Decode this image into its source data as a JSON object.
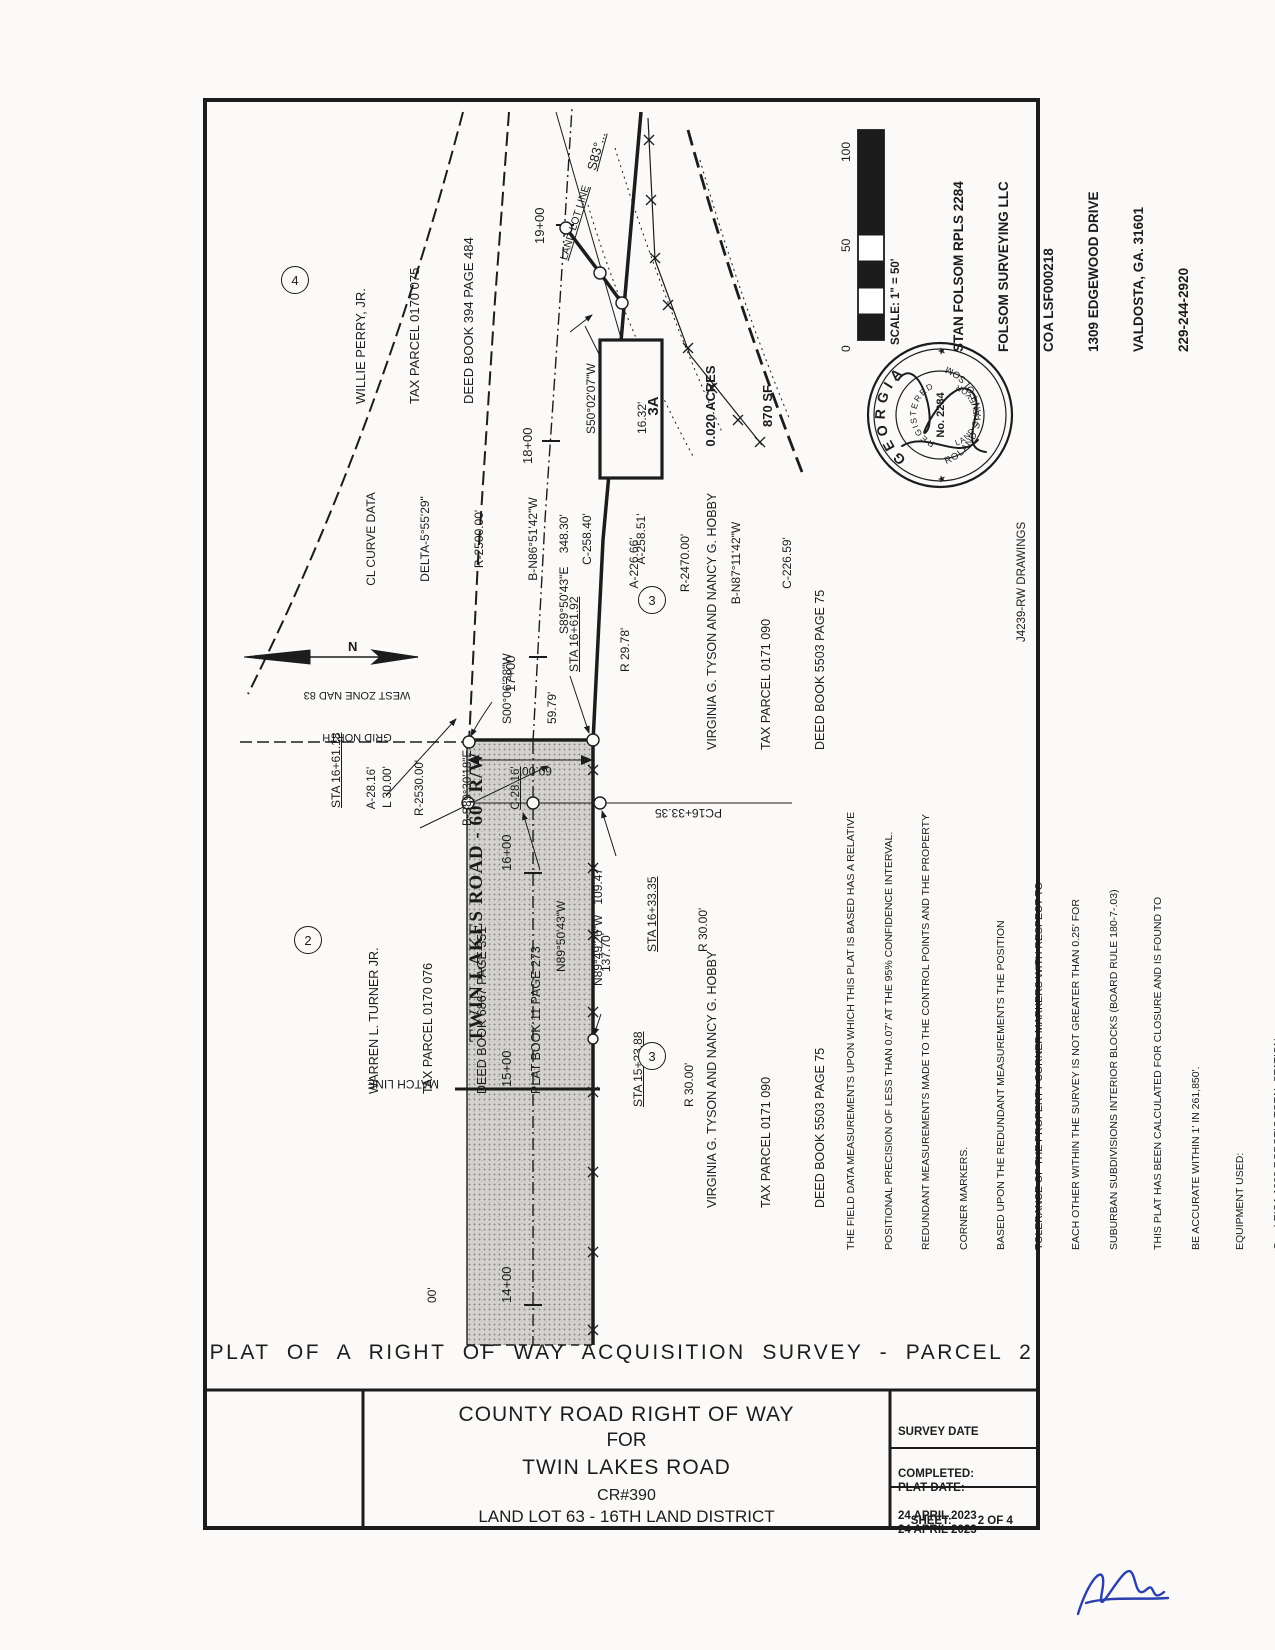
{
  "colors": {
    "ink": "#1c1c1c",
    "paper": "#fbfaf8",
    "road_fill": "#d3d2cf",
    "signature_blue": "#2b3fae"
  },
  "sheet": {
    "plat_title": "PLAT  OF  A  RIGHT  OF  WAY  ACQUISITION  SURVEY  -  PARCEL  2",
    "drawing_ref": "J4239-RW DRAWINGS"
  },
  "title_block": {
    "line1": "COUNTY ROAD RIGHT OF WAY",
    "line2": "FOR",
    "line3": "TWIN LAKES ROAD",
    "line4": "CR#390",
    "line5": "LAND LOT 63 - 16TH LAND DISTRICT",
    "survey_date_label": "SURVEY DATE",
    "survey_completed_label": "COMPLETED:",
    "survey_date": "24 APRIL 2023",
    "plat_date_label": "PLAT DATE:",
    "plat_date": "24 APRIL 2023",
    "sheet_label": "SHEET:",
    "sheet_value": "2 OF 4"
  },
  "surveyor": {
    "line1": "STAN FOLSOM RPLS 2284",
    "line2": "FOLSOM SURVEYING LLC",
    "line3": "COA LSF000218",
    "line4": "1309 EDGEWOOD DRIVE",
    "line5": "VALDOSTA, GA. 31601",
    "line6": "229-244-2920"
  },
  "scale_bar": {
    "label": "SCALE: 1\" = 50'",
    "tick0": "0",
    "tick50": "50",
    "tick100": "100"
  },
  "north_arrow": {
    "n": "N",
    "line1": "GRID NORTH",
    "line2": "WEST ZONE NAD 83"
  },
  "seal": {
    "state": "GEORGIA",
    "registered": "REGISTERED",
    "number": "No. 2284",
    "title": "LAND SURVEYOR",
    "name": "ROLAND STAN FOLSOM",
    "star": "★"
  },
  "parcels": {
    "perry": {
      "num": "4",
      "line1": "WILLIE PERRY, JR.",
      "line2": "TAX PARCEL 0170 075",
      "line3": "DEED BOOK 394 PAGE 484"
    },
    "turner": {
      "num": "2",
      "line1": "WARREN L. TURNER JR.",
      "line2": "TAX PARCEL 0170 076",
      "line3": "DEED BOOK 6867 PAGE 351",
      "line4": "PLAT BOOK 11 PAGE 273"
    },
    "tyson": {
      "num": "3",
      "line1": "VIRGINIA G. TYSON AND NANCY G. HOBBY",
      "line2": "TAX PARCEL 0171 090",
      "line3": "DEED BOOK 5503 PAGE 75"
    }
  },
  "area_box": {
    "id": "3A",
    "acres": "0.020 ACRES",
    "sf": "870 SF"
  },
  "cl_curve": {
    "title": "CL CURVE DATA",
    "delta": "DELTA-5°55'29\"",
    "r": "R-2500.00'",
    "b": "B-N86°51'42\"W",
    "c": "C-258.40'",
    "a": "A-258.51'"
  },
  "curve2": {
    "a": "A-226.66'",
    "r": "R-2470.00'",
    "b": "B-N87°11'42\"W",
    "c": "C-226.59'"
  },
  "curve3": {
    "a": "A-28.16'",
    "r": "R-2530.00'",
    "b": "B-S89°30'18\"E",
    "c": "C-28.16'"
  },
  "road": {
    "name": "TWIN LAKES ROAD - 60' R/W",
    "width_dim": "60.00'",
    "partial_dim": "00'"
  },
  "stations": {
    "s14": "14+00",
    "s15": "15+00",
    "s16": "16+00",
    "s17": "17+00",
    "s18": "18+00",
    "s19": "19+00"
  },
  "bearings": {
    "s50": "S50°02'07\"W",
    "s50_d": "16.32'",
    "s89": "S89°50'43\"E    348.30'",
    "s00": "S00°06'38\"W",
    "s00_d": "59.79'",
    "n89a": "N89°50'43\"W",
    "n89a_d": "137.70'",
    "n89b": "N89°49'26\"W   109.47'",
    "s83": "S83°..."
  },
  "sta_labels": {
    "sta16_61_92": "STA 16+61.92",
    "sta16_61_92_r": "R 29.78'",
    "sta16_61_18": "STA 16+61.18",
    "sta16_61_18_l": "L 30.00'",
    "sta16_33_35": "STA 16+33.35",
    "sta16_33_35_r": "R 30.00'",
    "sta15_23_88": "STA 15+23.88",
    "sta15_23_88_r": "R 30.00'",
    "pc": "PC16+33.35"
  },
  "map_labels": {
    "land_lot_line": "LAND LOT LINE",
    "match_line": "MATCH LINE"
  },
  "notes": {
    "l1": "THE FIELD DATA MEASUREMENTS UPON WHICH THIS PLAT IS BASED HAS A RELATIVE",
    "l2": "POSITIONAL PRECISION OF LESS THAN 0.07' AT THE 95% CONFIDENCE INTERVAL.",
    "l3": "REDUNDANT MEASUREMENTS MADE TO THE CONTROL POINTS AND THE PROPERTY",
    "l4": "CORNER MARKERS.",
    "l5": "BASED UPON THE REDUNDANT MEASUREMENTS THE POSITION",
    "l6": "TOLERANCE OF THE PROPERTY CORNER MARKERS WITH RESPECT TO",
    "l7": "EACH OTHER WITHIN THE SURVEY IS NOT GREATER THAN 0.25' FOR",
    "l8": "SUBURBAN SUBDIVISIONS INTERIOR BLOCKS (BOARD RULE 180-7-.03)",
    "l9": "THIS PLAT HAS BEEN CALCULATED FOR CLOSURE AND IS FOUND TO",
    "l10": "BE ACCURATE WITHIN 1' IN 261,850'.",
    "l11": "EQUIPMENT USED:",
    "l12": "O     LEICA 1203 ROBOTIC TOTAL STATION",
    "l13": "O     JAVAD TRIUMPH - LS PLUS ROVER AND JAVAD TRIUMPH-3   BASE STATION",
    "l14": "O     100' STEEL TAPE"
  }
}
